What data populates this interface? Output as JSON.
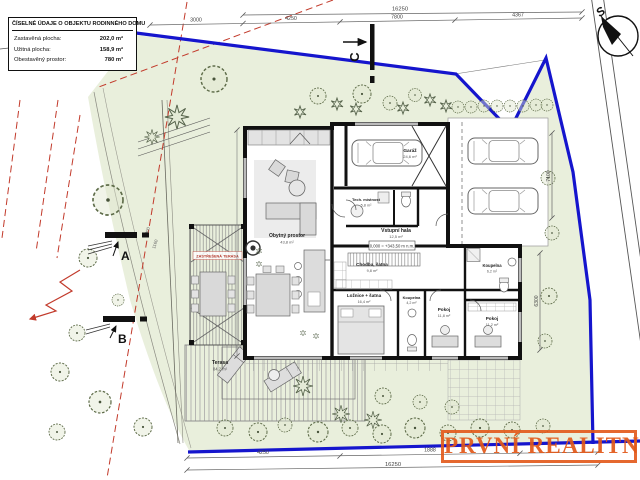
{
  "info_box": {
    "title": "ČÍSELNÉ ÚDAJE O OBJEKTU RODINNÉHO DOMU",
    "rows": [
      {
        "label": "Zastavěná plocha:",
        "value": "202,0 m²"
      },
      {
        "label": "Užitná plocha:",
        "value": "158,9 m²"
      },
      {
        "label": "Obestavěný prostor:",
        "value": "780 m³"
      }
    ]
  },
  "watermark": {
    "text": "PRVNÍ REALITNÍ",
    "color": "#e2581b"
  },
  "compass": {
    "label": "S"
  },
  "sections": {
    "a": "A",
    "b": "B",
    "c": "C"
  },
  "rooms": {
    "living": {
      "name": "Obytný prostor",
      "area": "43,8 m²"
    },
    "garage": {
      "name": "Garáž",
      "area": "24,6 m²"
    },
    "tech": {
      "name": "Tech. místnost",
      "area": "5,8 m²"
    },
    "hall": {
      "name": "Vstupní hala",
      "area": "12,5 m²"
    },
    "corridor": {
      "name": "Chodba, šatna",
      "area": "9,8 m²"
    },
    "bedroom": {
      "name": "Ložnice + šatna",
      "area": "16,4 m²"
    },
    "bath_small": {
      "name": "Koupelna",
      "area": "4,2 m²"
    },
    "bath_main": {
      "name": "Koupelna",
      "area": "6,2 m²"
    },
    "room1": {
      "name": "Pokoj",
      "area": "11,8 m²"
    },
    "room2": {
      "name": "Pokoj",
      "area": "11,2 m²"
    },
    "terrace": {
      "name": "Terasa",
      "area": "84,2 m²"
    }
  },
  "notes": {
    "pergola": "ZASTŘEŠENÁ TERASA",
    "elevation": "0,000 = +343,50 m n.m."
  },
  "dimensions": {
    "top_total": "16250",
    "top_segments": [
      "3000",
      "4250",
      "7800",
      "4367"
    ],
    "bottom_total": "16250",
    "bottom_segments": [
      "4250",
      "1888"
    ],
    "parking_depth": "7100",
    "garden_right": "6300",
    "left_small": [
      "1900",
      "1160"
    ]
  }
}
